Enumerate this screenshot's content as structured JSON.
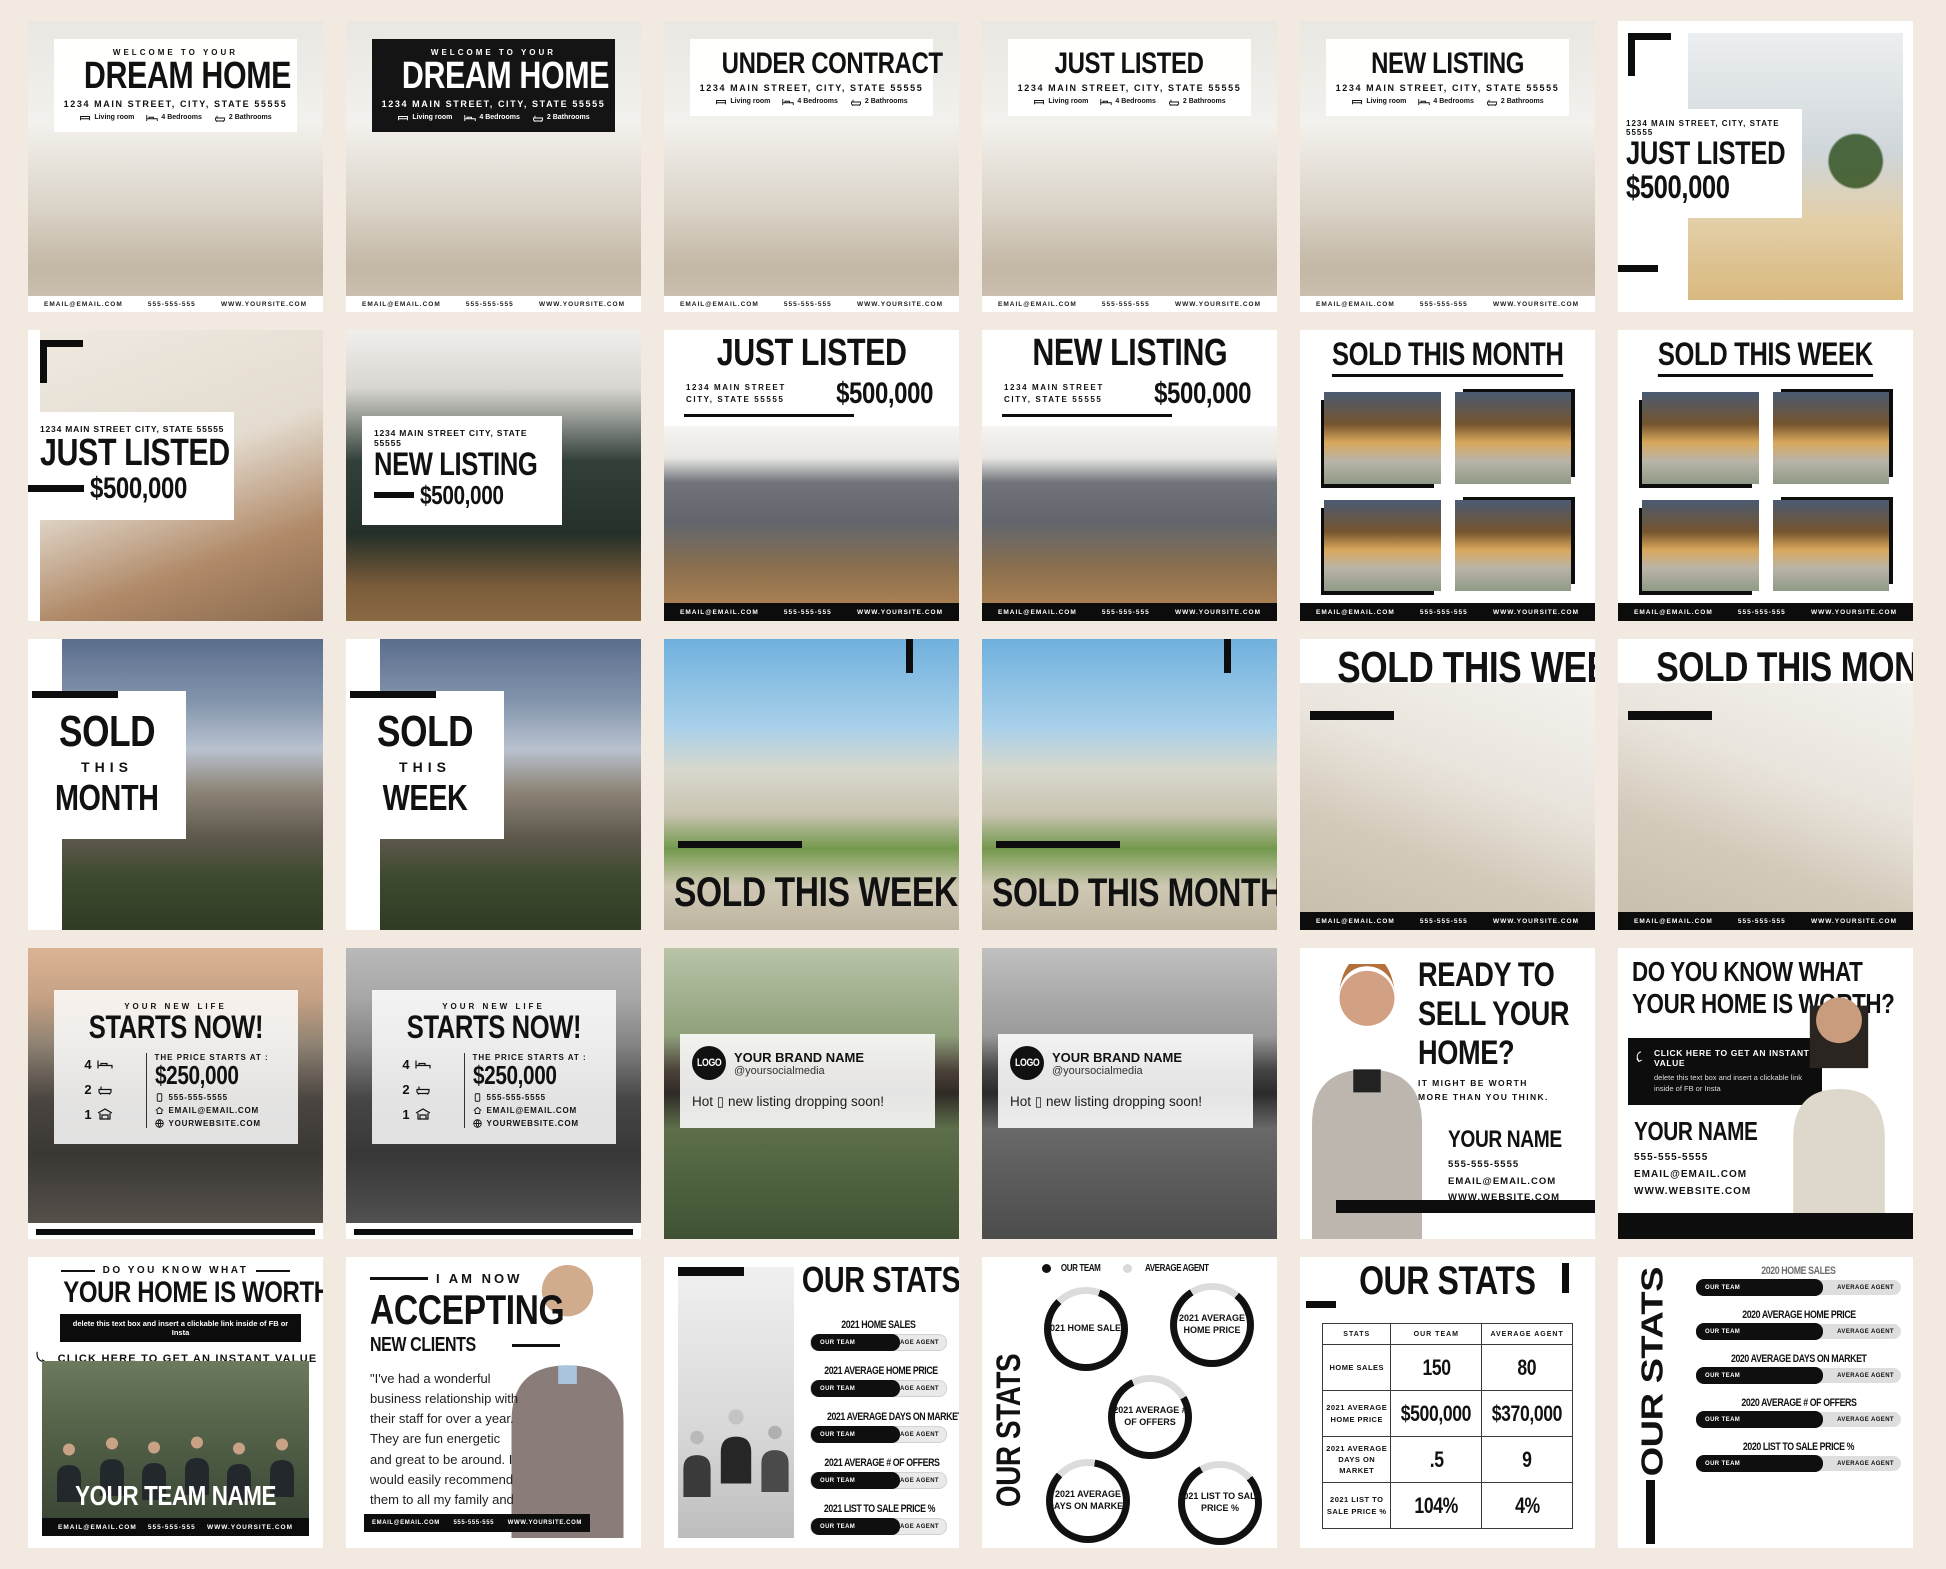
{
  "palette": {
    "page_bg": "#f2e9e0",
    "accent_black": "#0d0d0d",
    "card_white": "#ffffff"
  },
  "shared": {
    "footer": {
      "email": "EMAIL@EMAIL.COM",
      "phone": "555-555-555",
      "site": "WWW.YOURSITE.COM"
    },
    "features": [
      {
        "icon": "sofa-icon",
        "label": "Living room"
      },
      {
        "icon": "bed-icon",
        "label": "4 Bedrooms"
      },
      {
        "icon": "bath-icon",
        "label": "2 Bathrooms"
      }
    ],
    "address": "1234 MAIN STREET, CITY, STATE 55555",
    "address2": "1234 MAIN STREET CITY, STATE 55555",
    "addr_l1": "1234 MAIN STREET",
    "addr_l2": "CITY, STATE 55555",
    "price": "$500,000",
    "bar_team": "OUR TEAM",
    "bar_agent": "AVERAGE AGENT"
  },
  "tiles": {
    "r1c1": {
      "eyebrow": "WELCOME TO YOUR",
      "title": "DREAM HOME"
    },
    "r1c2": {
      "eyebrow": "WELCOME TO YOUR",
      "title": "DREAM HOME"
    },
    "r1c3": {
      "title": "UNDER CONTRACT"
    },
    "r1c4": {
      "title": "JUST LISTED"
    },
    "r1c5": {
      "title": "NEW LISTING"
    },
    "r1c6": {
      "title": "JUST LISTED",
      "price": "$500,000"
    },
    "r2c1": {
      "title": "JUST LISTED",
      "price": "$500,000"
    },
    "r2c2": {
      "title": "NEW LISTING",
      "price": "$500,000"
    },
    "r2c3": {
      "title": "JUST LISTED",
      "price": "$500,000"
    },
    "r2c4": {
      "title": "NEW LISTING",
      "price": "$500,000"
    },
    "r2c5": {
      "title": "SOLD THIS MONTH"
    },
    "r2c6": {
      "title": "SOLD THIS WEEK"
    },
    "r3c1": {
      "l1": "SOLD",
      "l2": "THIS",
      "l3": "MONTH"
    },
    "r3c2": {
      "l1": "SOLD",
      "l2": "THIS",
      "l3": "WEEK"
    },
    "r3c3": {
      "title": "SOLD THIS WEEK"
    },
    "r3c4": {
      "title": "SOLD THIS MONTH"
    },
    "r3c5": {
      "title": "SOLD THIS WEEK"
    },
    "r3c6": {
      "title": "SOLD THIS MONTH"
    },
    "r4c1": {
      "eyebrow": "YOUR NEW LIFE",
      "title": "STARTS NOW!",
      "beds": "4",
      "baths": "2",
      "garage": "1",
      "price_label": "THE PRICE STARTS AT :",
      "price": "$250,000",
      "phone": "555-555-5555",
      "email": "EMAIL@EMAIL.COM",
      "site": "YOURWEBSITE.COM"
    },
    "r4c2": {
      "eyebrow": "YOUR NEW LIFE",
      "title": "STARTS NOW!",
      "beds": "4",
      "baths": "2",
      "garage": "1",
      "price_label": "THE PRICE STARTS AT :",
      "price": "$250,000",
      "phone": "555-555-5555",
      "email": "EMAIL@EMAIL.COM",
      "site": "YOURWEBSITE.COM"
    },
    "r4c3": {
      "logo": "LOGO",
      "brand": "YOUR BRAND NAME",
      "handle": "@yoursocialmedia",
      "caption": "Hot ▯ new listing dropping soon!"
    },
    "r4c4": {
      "logo": "LOGO",
      "brand": "YOUR BRAND NAME",
      "handle": "@yoursocialmedia",
      "caption": "Hot ▯ new listing dropping soon!"
    },
    "r4c5": {
      "title1": "READY TO",
      "title2": "SELL YOUR",
      "title3": "HOME?",
      "sub": "IT MIGHT BE WORTH MORE THAN YOU THINK.",
      "name": "YOUR NAME",
      "phone": "555-555-5555",
      "email": "EMAIL@EMAIL.COM",
      "site": "WWW.WEBSITE.COM"
    },
    "r4c6": {
      "title1": "DO YOU KNOW WHAT",
      "title2": "YOUR HOME IS WORTH?",
      "cta": "CLICK HERE TO GET AN INSTANT VALUE",
      "cta_sub": "delete this text box and insert a clickable link inside of FB or Insta",
      "name": "YOUR NAME",
      "phone": "555-555-5555",
      "email": "EMAIL@EMAIL.COM",
      "site": "WWW.WEBSITE.COM"
    },
    "r5c1": {
      "eyebrow": "DO YOU KNOW WHAT",
      "title": "YOUR HOME IS WORTH?",
      "note": "delete this text box and insert a clickable link inside of FB or Insta",
      "cta": "CLICK HERE TO GET AN INSTANT VALUE",
      "team": "YOUR TEAM NAME"
    },
    "r5c2": {
      "eyebrow": "I AM NOW",
      "title": "ACCEPTING",
      "sub": "NEW CLIENTS",
      "quote": "\"I've had a wonderful business relationship with their staff for over a year. They are fun energetic and great to be around. I would easily recommend them to all my family and friends.\"",
      "email": "EMAIL@EMAIL.COM",
      "phone": "555-555-555",
      "site": "WWW.YOURSITE.COM"
    },
    "r5c3": {
      "title": "OUR STATS",
      "stats": [
        "2021 HOME SALES",
        "2021 AVERAGE HOME PRICE",
        "2021 AVERAGE DAYS ON MARKET",
        "2021 AVERAGE # OF OFFERS",
        "2021 LIST TO SALE PRICE %"
      ]
    },
    "r5c4": {
      "vtitle": "OUR STATS",
      "legend": [
        "OUR TEAM",
        "AVERAGE AGENT"
      ],
      "circles": [
        "2021 HOME SALES",
        "2021 AVERAGE HOME PRICE",
        "2021 AVERAGE # OF OFFERS",
        "2021 AVERAGE DAYS ON MARKET",
        "2021 LIST TO SALE PRICE %"
      ]
    },
    "r5c5": {
      "title": "OUR STATS",
      "table": {
        "headers": [
          "STATS",
          "OUR TEAM",
          "AVERAGE AGENT"
        ],
        "rows": [
          [
            "HOME SALES",
            "150",
            "80"
          ],
          [
            "2021 AVERAGE HOME PRICE",
            "$500,000",
            "$370,000"
          ],
          [
            "2021 AVERAGE DAYS ON MARKET",
            ".5",
            "9"
          ],
          [
            "2021 LIST TO SALE PRICE %",
            "104%",
            "4%"
          ]
        ]
      }
    },
    "r5c6": {
      "vtitle": "OUR STATS",
      "stats": [
        "2020 HOME SALES",
        "2020 AVERAGE HOME PRICE",
        "2020 AVERAGE DAYS ON MARKET",
        "2020 AVERAGE # OF OFFERS",
        "2020 LIST TO SALE PRICE %"
      ]
    }
  }
}
